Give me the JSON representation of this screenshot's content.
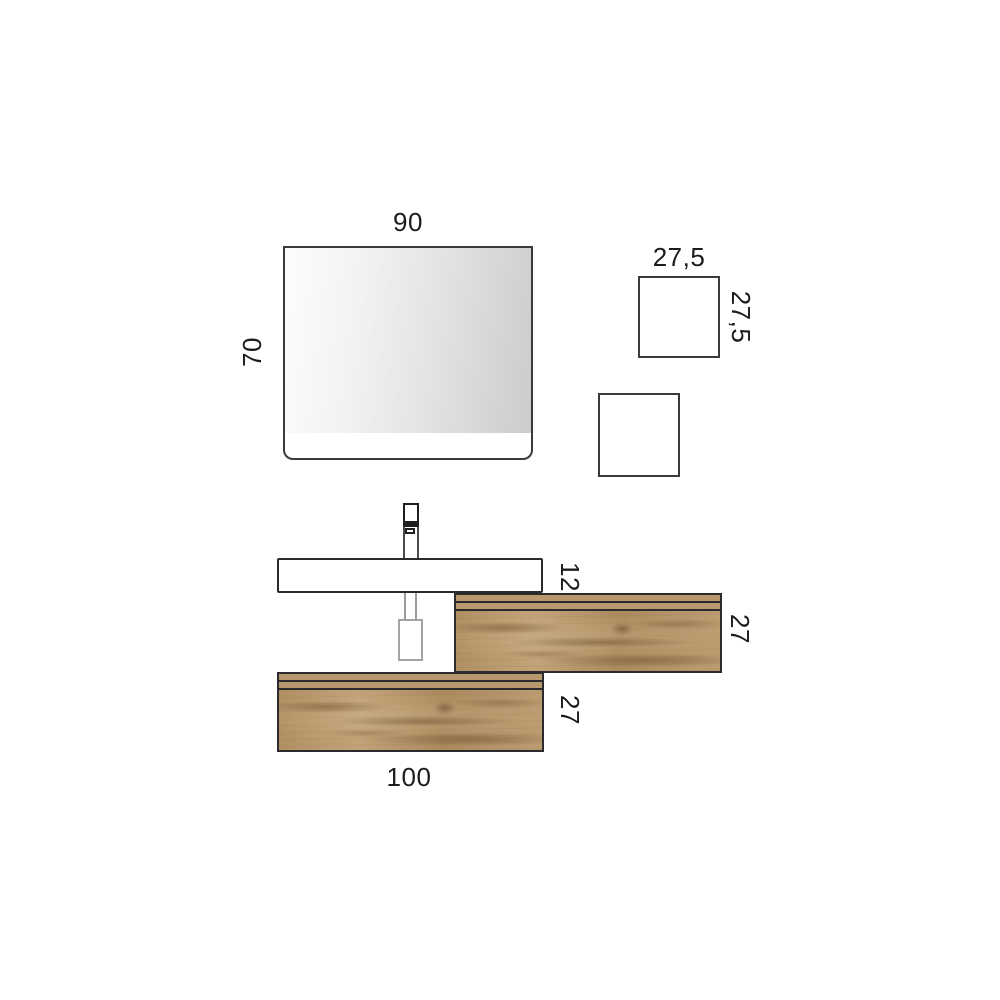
{
  "labels": {
    "mirror_width": "90",
    "mirror_height": "70",
    "wall_box_width": "27,5",
    "wall_box_height": "27,5",
    "basin_height": "12",
    "upper_drawer_height": "27",
    "lower_drawer_height": "27",
    "lower_drawer_width": "100"
  },
  "colors": {
    "outline": "#2b2b2d",
    "wood_base": "#b4956b",
    "mirror_gradient_start": "#fdfdfd",
    "mirror_gradient_end": "#cbcccd",
    "drain_gray": "#9b9b9d",
    "background": "#ffffff",
    "label_text": "#1c1c1c"
  }
}
